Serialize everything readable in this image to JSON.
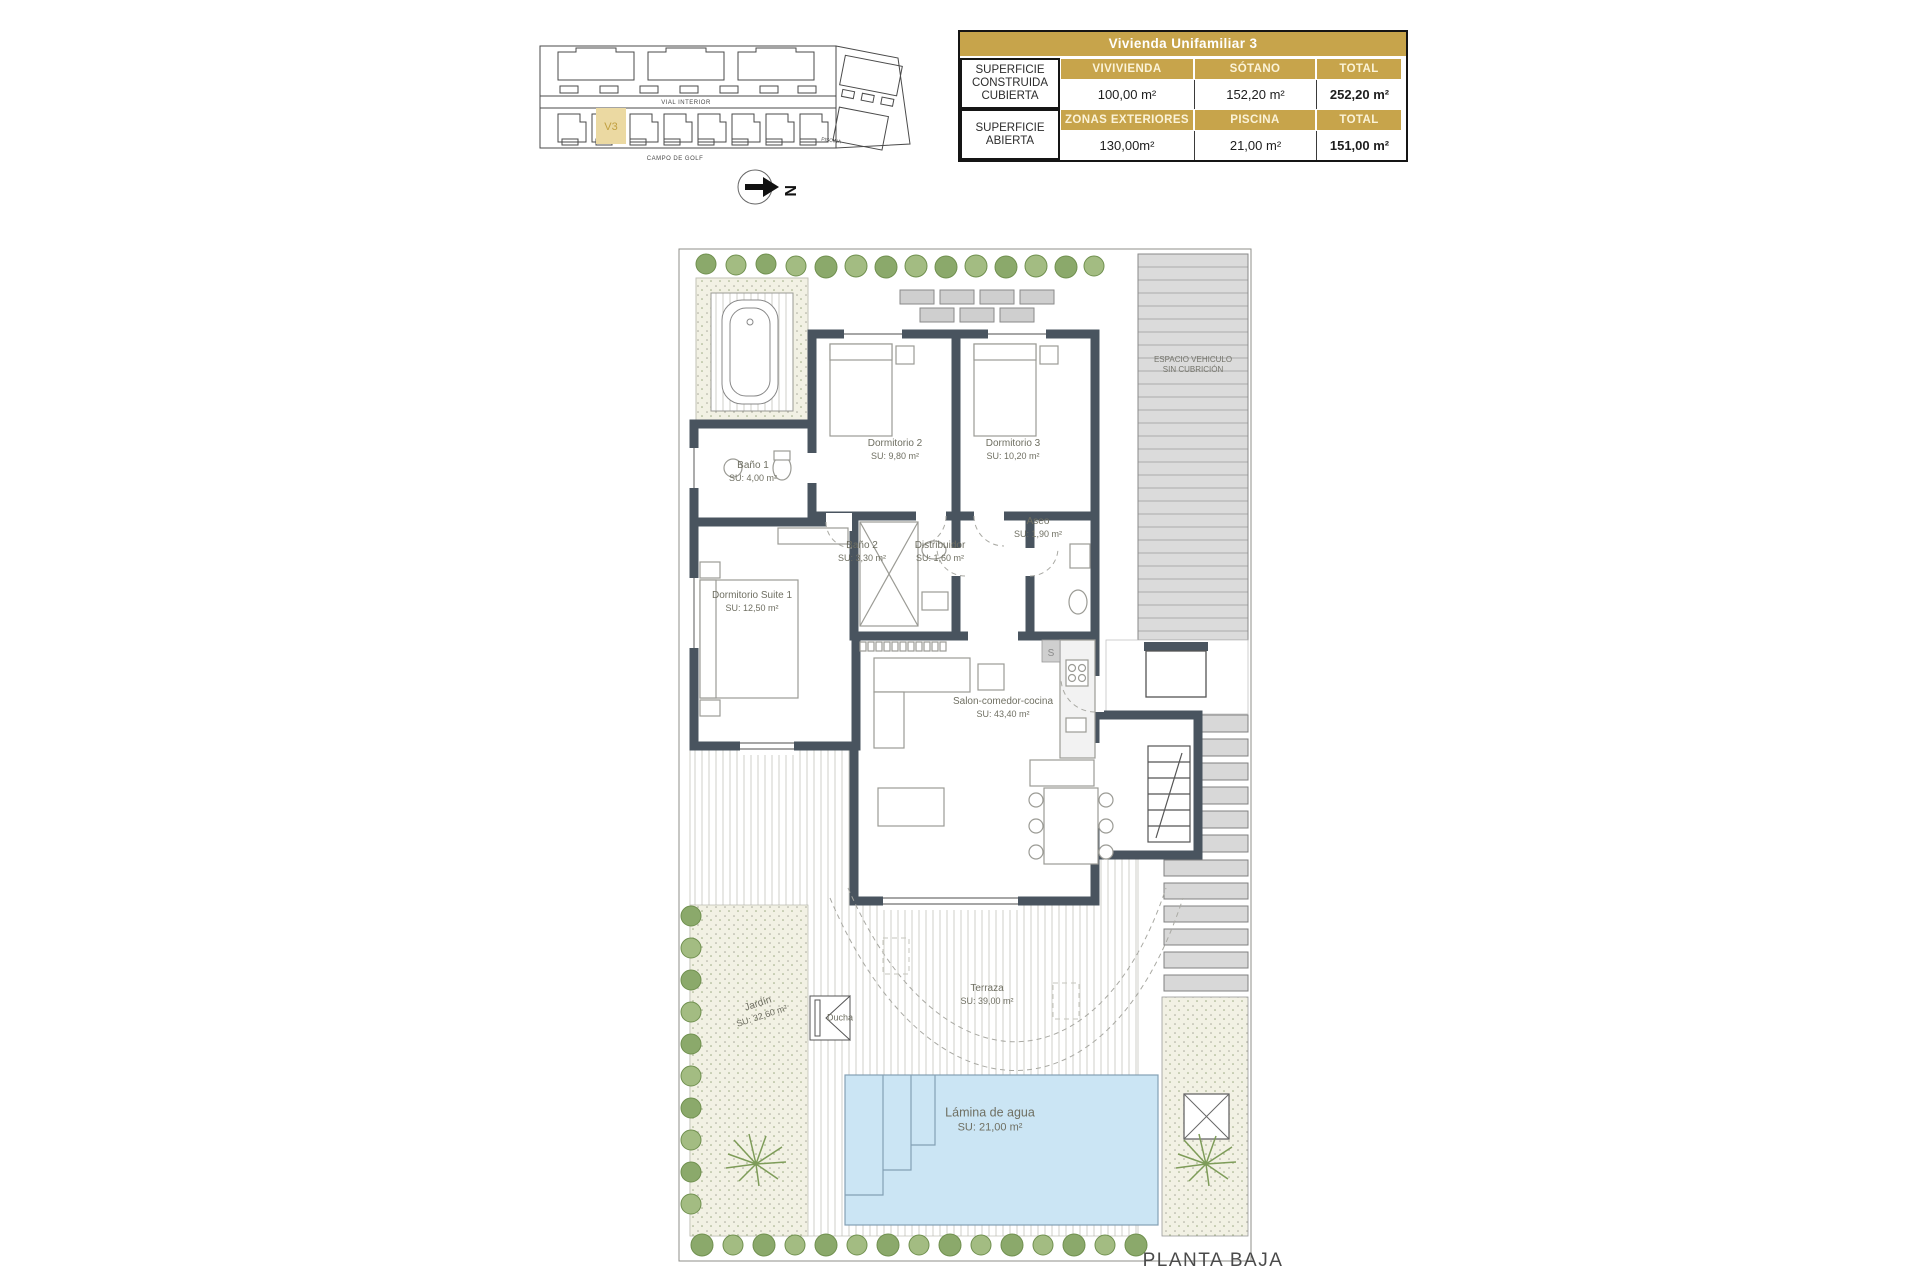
{
  "table": {
    "title": "Vivienda Unifamiliar 3",
    "g1": {
      "label": "SUPERFICIE CONSTRUIDA CUBIERTA",
      "c1": "VIVIVIENDA",
      "c2": "SÓTANO",
      "c3": "TOTAL",
      "v1": "100,00 m²",
      "v2": "152,20 m²",
      "v3": "252,20 m²"
    },
    "g2": {
      "label": "SUPERFICIE ABIERTA",
      "c1": "ZONAS EXTERIORES",
      "c2": "PISCINA",
      "c3": "TOTAL",
      "v1": "130,00m²",
      "v2": "21,00 m²",
      "v3": "151,00 m²"
    }
  },
  "site": {
    "vial": "VIAL INTERIOR",
    "golf": "CAMPO DE GOLF",
    "piscina": "PISCINA",
    "unit": "V3",
    "north": "N"
  },
  "plan": {
    "rooms": {
      "bano1": {
        "name": "Baño 1",
        "su": "SU: 4,00 m²"
      },
      "dorm2": {
        "name": "Dormitorio 2",
        "su": "SU: 9,80 m²"
      },
      "dorm3": {
        "name": "Dormitorio 3",
        "su": "SU: 10,20 m²"
      },
      "bano2": {
        "name": "Baño 2",
        "su": "SU: 3,30 m²"
      },
      "distribuidor": {
        "name": "Distribuidor",
        "su": "SU: 1,60 m²"
      },
      "aseo": {
        "name": "Aseo",
        "su": "SU: 1,90 m²"
      },
      "suite": {
        "name": "Dormitorio Suite 1",
        "su": "SU: 12,50 m²"
      },
      "salon": {
        "name": "Salon-comedor-cocina",
        "su": "SU: 43,40 m²"
      },
      "terraza": {
        "name": "Terraza",
        "su": "SU: 39,00 m²"
      },
      "jardin": {
        "name": "Jardín",
        "su": "SU: 32,60 m²"
      },
      "lamina": {
        "name": "Lámina de agua",
        "su": "SU: 21,00 m²"
      },
      "ducha": {
        "name": "Ducha"
      },
      "vehiculo": {
        "line1": "ESPACIO VEHICULO",
        "line2": "SIN CUBRICIÓN"
      }
    },
    "kitchen_mark": "S",
    "caption": "PLANTA BAJA"
  },
  "colors": {
    "gold": "#C7A44B",
    "gold_light": "#EBD9A2",
    "wall": "#49545F",
    "pool": "#CBE5F4",
    "plant": "#8BA96B",
    "pavement": "#DBDBDB"
  }
}
